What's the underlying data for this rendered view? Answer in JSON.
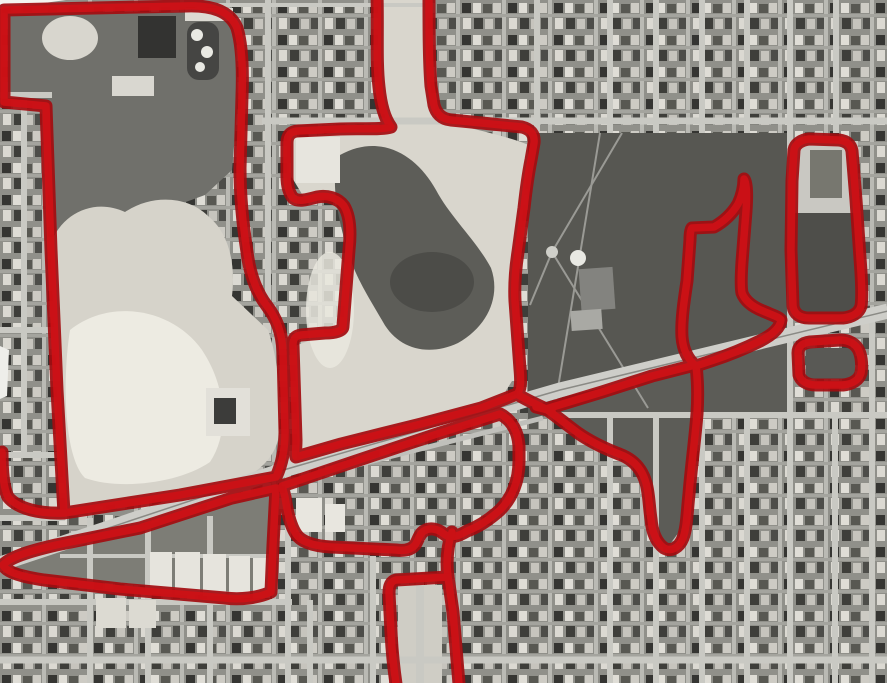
{
  "meta": {
    "description": "Black-and-white aerial photograph of an urban street grid with large cleared quarry areas, a dark park, a diagonal highway, and thick hand-drawn red outlines marking several land parcels. No text is visible in the image.",
    "image_type": "annotated aerial photograph",
    "width_px": 887,
    "height_px": 683
  },
  "palette": {
    "overlay_red_base": "#a30c10",
    "overlay_red_bright": "#cf1116",
    "photo_base": "#8e8e88",
    "street_gray": "#c9c9c3",
    "quarry_light": "#dcd9d0",
    "park_dark": "#575752",
    "highway_gray": "#cecec9"
  },
  "overlay": {
    "paths": {
      "left_parcel": "M 4 10 L 186 6 C 212 5 230 11 237 28 C 242 45 243 70 242 96 L 240 168 C 240 200 243 226 247 252 C 250 276 257 293 267 306 C 276 318 282 331 283 352 L 285 432 C 285 447 283 462 276 477 L 180 495 L 64 513 L 57 390 L 51 250 L 46 106 L 4 102 Z",
      "left_parcel_tail": "M 64 513 C 40 514 18 509 8 497 C 3 487 2 468 2 452",
      "center_parcel": "M 377 -6 C 378 30 376 62 379 87 C 381 107 385 119 391 127 C 381 130 360 128 340 129 L 297 131 C 290 132 287 136 287 143 L 287 176 C 287 186 289 193 293 198 C 298 202 306 200 317 197 C 327 195 338 198 344 206 C 350 216 351 232 349 250 L 343 326 C 343 331 335 333 325 333 L 301 335 C 295 336 293 339 293 345 L 296 440 C 296 449 295 453 296 457 L 341 444 L 421 424 L 481 408 L 517 394 C 521 390 521 380 520 369 L 515 301 C 514 281 516 265 518 252 L 524 208 C 526 190 528 175 531 160 L 534 143 C 535 134 530 129 522 127 L 451 120 C 441 119 436 113 434 105 L 431 86 C 429 60 429 28 429 -6",
      "south_strip_parcel": "M 3 565 C 10 557 30 551 56 545 L 140 528 L 232 498 L 276 488 L 273 545 L 271 592 C 258 598 240 600 225 598 L 120 589 L 44 580 C 24 577 7 573 3 565 Z",
      "lower_center_parcel": "M 282 486 L 356 461 L 440 433 L 500 414 C 512 420 518 432 519 446 L 519 461 C 519 481 512 498 500 510 C 490 519 478 527 467 531 C 459 536 450 539 444 534 C 438 529 430 527 424 531 C 419 534 418 541 415 545 C 411 550 404 551 396 550 L 331 547 C 314 546 301 542 296 534 C 290 525 287 511 285 497 Z",
      "south_leg": "M 452 532 C 447 547 446 561 448 577 L 453 612 C 455 637 457 661 459 684",
      "bottom_u": "M 448 577 L 396 580 C 391 581 389 586 389 593 L 391 632 C 392 652 394 670 396 684",
      "connector_lines": "M 517 394 C 526 400 536 404 546 409 M 536 407 L 552 411 M 546 409 L 602 392 L 652 376 L 695 365 M 546 409 C 556 416 566 424 578 433 C 591 442 606 449 619 454",
      "hook_parcel": "M 619 454 C 633 459 642 469 646 483 C 649 493 649 506 651 519 C 652 531 656 542 664 548 C 671 552 679 548 683 538 C 687 527 687 512 689 494 C 691 469 695 439 697 414 C 698 398 698 382 696 366",
      "narrow_parcel": "M 696 366 C 687 359 683 349 682 337 C 681 321 684 301 687 281 L 690 240 C 690 233 691 229 692 228 L 714 227 C 723 222 732 214 738 204 C 742 196 744 186 744 179 C 747 183 747 196 746 211 L 742 262 C 741 277 741 288 742 293 C 745 301 753 307 763 311 C 772 315 779 317 781 320 C 780 328 772 335 760 341 C 746 348 726 356 711 361 C 705 363 699 365 696 366 Z",
      "tall_east_parcel": "M 794 150 C 795 144 801 140 809 139 L 839 140 C 847 141 851 145 852 151 L 856 200 L 860 258 C 862 284 862 300 861 306 C 859 313 852 317 843 318 L 809 318 C 800 318 794 314 793 306 L 791 250 L 792 181 Z",
      "small_east_ring": "M 798 353 C 798 347 802 343 810 342 L 840 340 C 849 340 856 344 859 351 C 862 358 862 367 861 373 C 859 380 852 384 843 385 L 816 385 C 807 385 801 381 799 375 Z"
    }
  }
}
